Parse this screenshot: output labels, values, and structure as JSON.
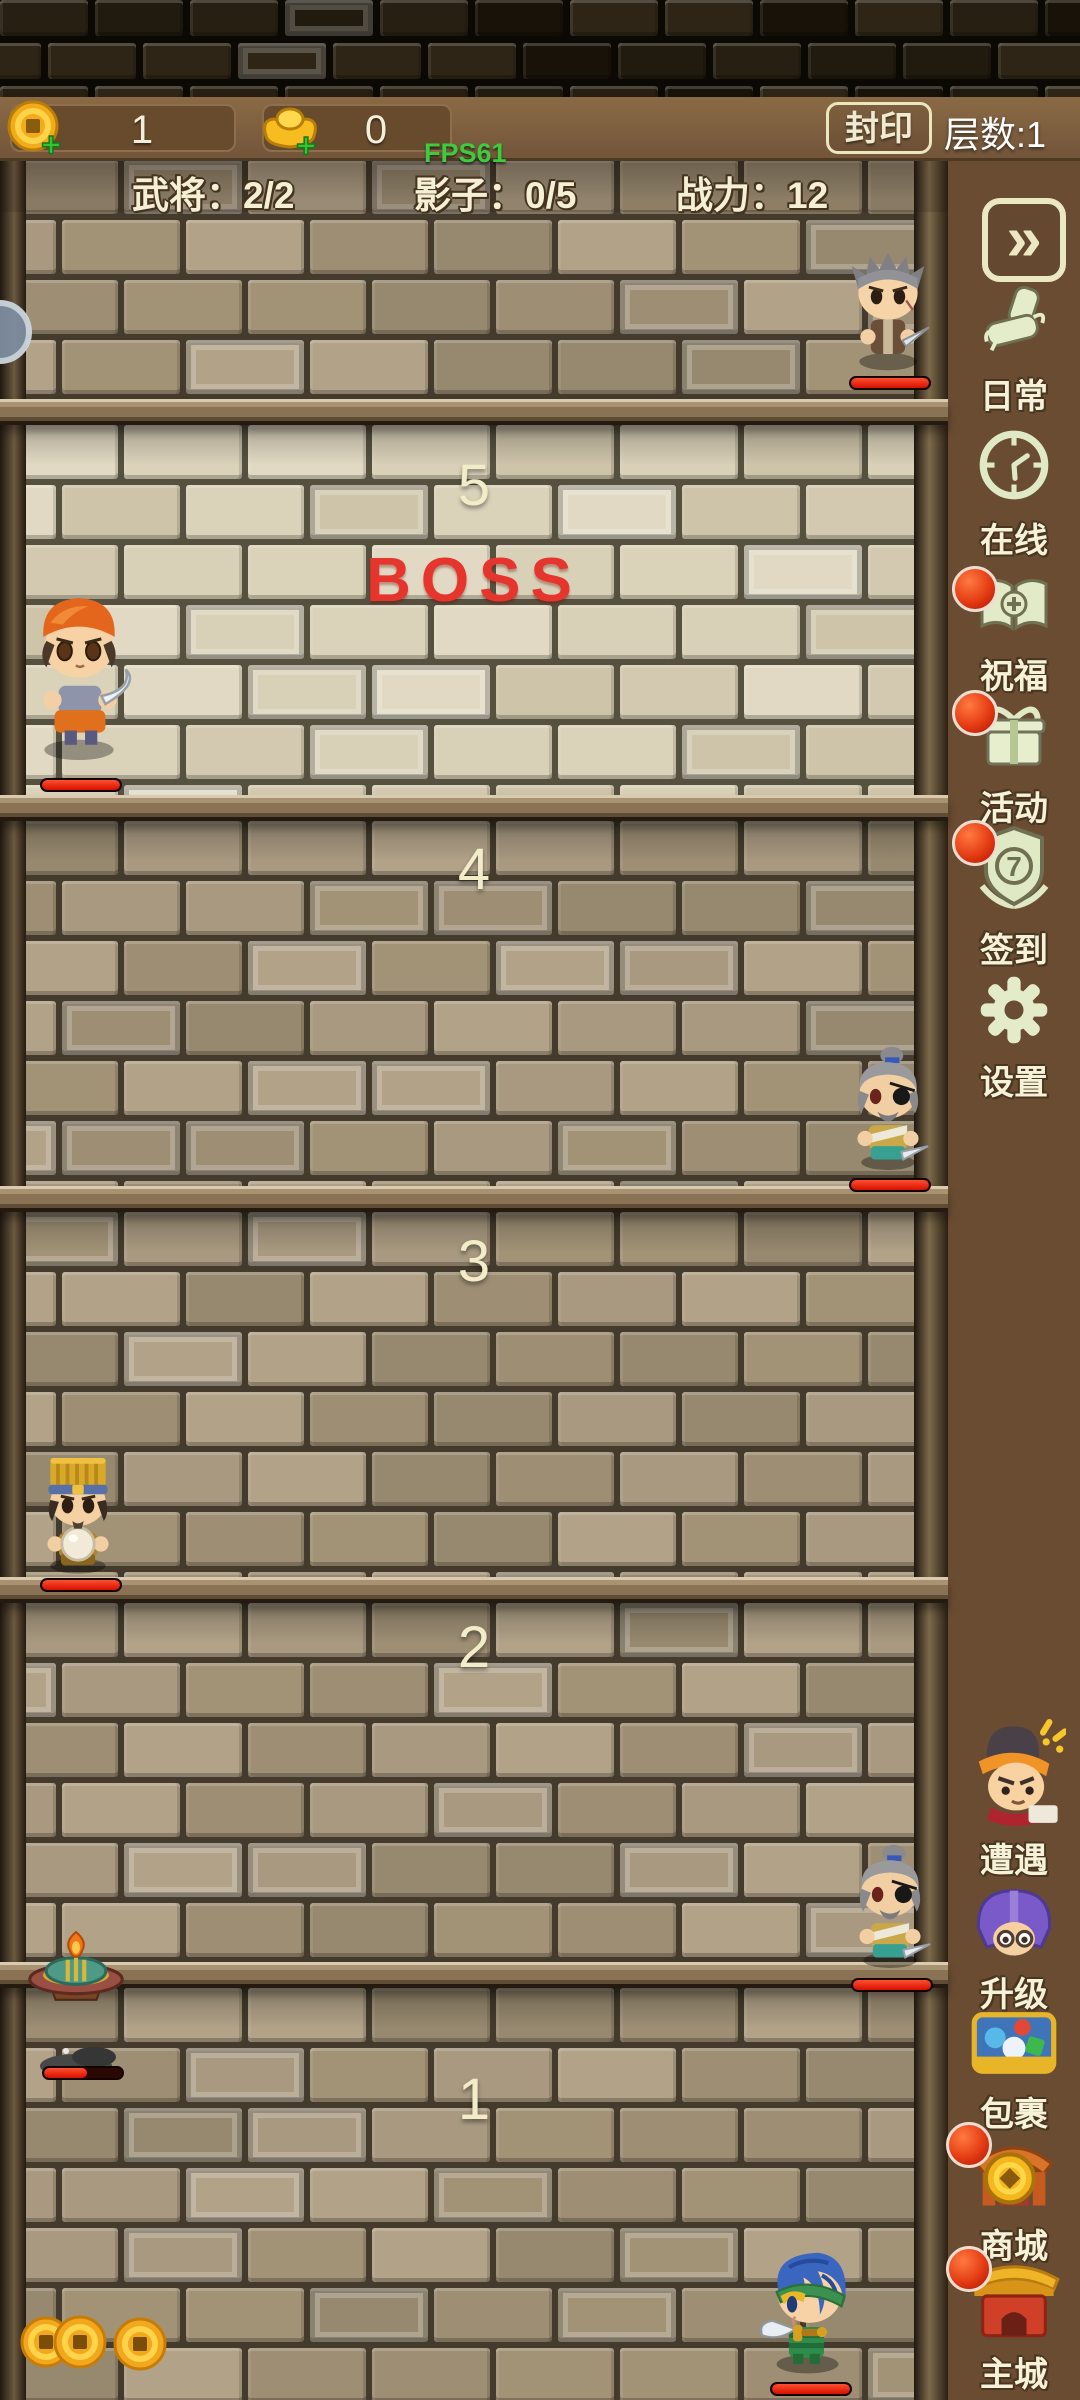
{
  "hud": {
    "coin_value": "1",
    "ingot_value": "0",
    "plus_glyph": "+",
    "fps_label": "FPS61",
    "seal_button_label": "封印",
    "floor_counter_label": "层数:1",
    "stats": {
      "generals": "武将：2/2",
      "shadows": "影子：0/5",
      "power": "战力：12"
    }
  },
  "sidebar": {
    "expand_glyph": "»",
    "top_items": [
      {
        "label": "日常",
        "icon": "scroll-icon",
        "badge": false
      },
      {
        "label": "在线",
        "icon": "clock-icon",
        "badge": false
      },
      {
        "label": "祝福",
        "icon": "blessing-book-icon",
        "badge": true
      },
      {
        "label": "活动",
        "icon": "gift-icon",
        "badge": true
      },
      {
        "label": "签到",
        "icon": "signin-shield-icon",
        "badge": true,
        "icon_text": "7"
      },
      {
        "label": "设置",
        "icon": "gear-icon",
        "badge": false
      }
    ],
    "bottom_items": [
      {
        "label": "遭遇",
        "icon": "encounter-face-icon",
        "badge": false
      },
      {
        "label": "升级",
        "icon": "upgrade-helmet-icon",
        "badge": false
      },
      {
        "label": "包裹",
        "icon": "backpack-chest-icon",
        "badge": false
      },
      {
        "label": "商城",
        "icon": "shop-coin-icon",
        "badge": true
      },
      {
        "label": "主城",
        "icon": "main-city-gate-icon",
        "badge": true
      }
    ]
  },
  "tower": {
    "floors": [
      {
        "number": "5",
        "boss_label": "BOSS"
      },
      {
        "number": "4"
      },
      {
        "number": "3"
      },
      {
        "number": "2"
      },
      {
        "number": "1"
      }
    ]
  },
  "units": {
    "top_enemy": {
      "hp": 100
    },
    "boss": {
      "hp": 100
    },
    "floor4_enemy": {
      "hp": 100
    },
    "floor3_general": {
      "hp": 100
    },
    "floor2_enemy": {
      "hp": 100
    },
    "floor1_shadow": {
      "hp": 55
    },
    "floor1_hero": {
      "hp": 100
    }
  },
  "colors": {
    "badge_red": "#e03a12",
    "hp_red": "#d81808",
    "boss_text": "#e6352c",
    "fps_green": "#3ecb3e",
    "hud_brown": "#7d5e3e"
  }
}
